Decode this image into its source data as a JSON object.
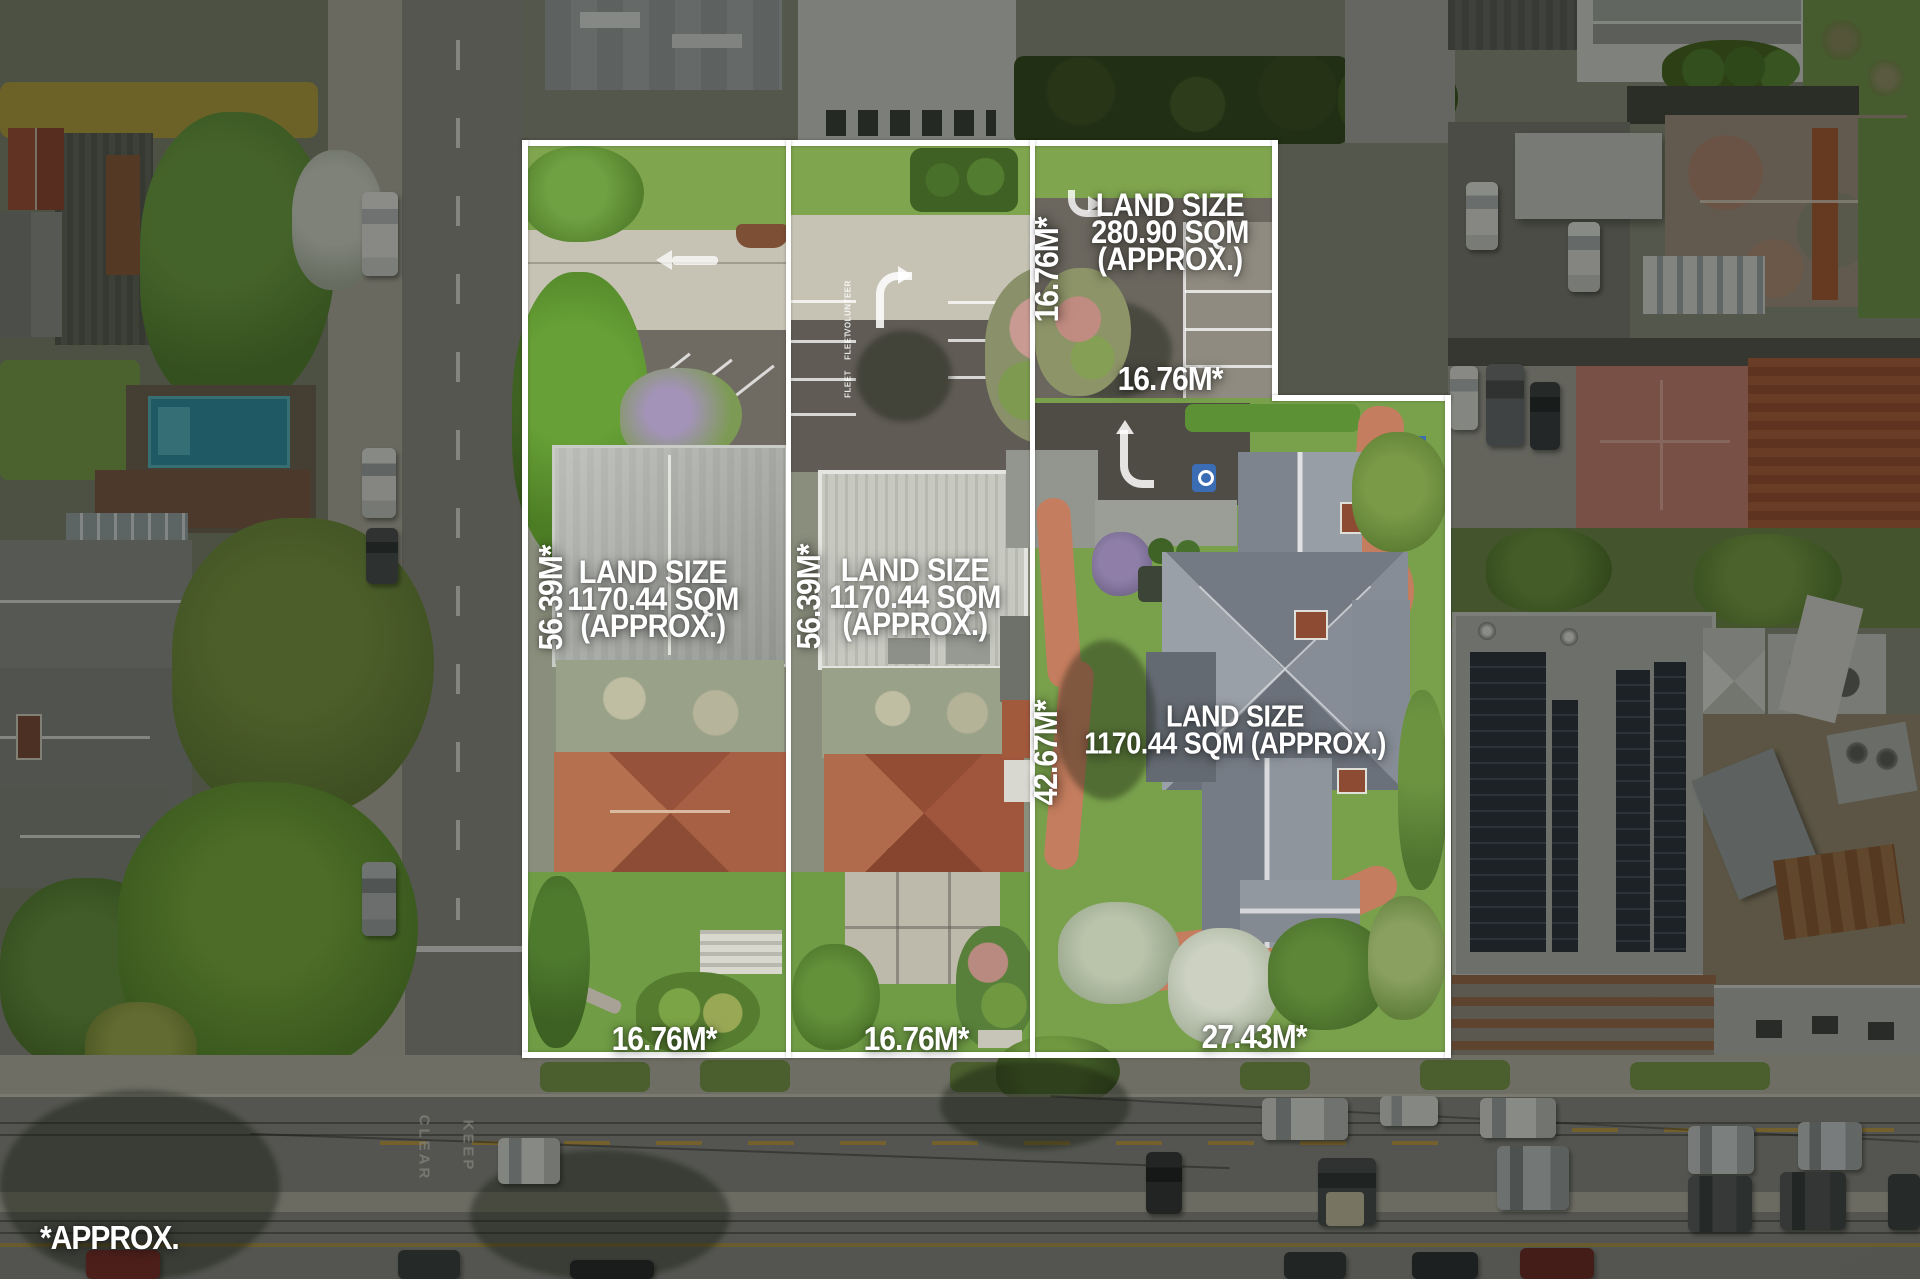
{
  "watermark": "*APPROX.",
  "parcels": [
    {
      "id": "left",
      "land_size_line1": "LAND SIZE",
      "land_size_line2": "1170.44 SQM",
      "land_size_line3": "(APPROX.)",
      "west_dim": "56.39M*",
      "south_dim": "16.76M*"
    },
    {
      "id": "middle",
      "land_size_line1": "LAND SIZE",
      "land_size_line2": "1170.44 SQM",
      "land_size_line3": "(APPROX.)",
      "west_dim": "56.39M*",
      "south_dim": "16.76M*"
    },
    {
      "id": "rear",
      "land_size_line1": "LAND SIZE",
      "land_size_line2": "280.90 SQM",
      "land_size_line3": "(APPROX.)",
      "west_dim": "16.76M*",
      "south_dim": "16.76M*"
    },
    {
      "id": "right",
      "land_size_line1": "LAND SIZE",
      "land_size_line2": "1170.44 SQM (APPROX.)",
      "west_dim": "42.67M*",
      "south_dim": "27.43M*"
    }
  ],
  "road_markings": {
    "keep": "KEEP",
    "clear": "CLEAR"
  },
  "parking_bays": {
    "bay1": "VOLUNTEER",
    "bay2": "FLEET",
    "bay3": "FLEET"
  },
  "icons": {
    "disabled_parking": "wheelchair-parking-symbol",
    "turn_arrow": "turn-arrow-marking"
  },
  "colors": {
    "boundary": "#ffffff",
    "label_text": "#ffffff",
    "mask": "rgba(9,11,8,0.42)",
    "grass": "#7fa54e",
    "asphalt": "#6b675f",
    "pool_water": "#2f93a8",
    "brick_path": "#c47d5e",
    "solar_panel": "#2b323e",
    "terracotta_roof": "#a05a40",
    "slate_roof": "#878d96"
  }
}
